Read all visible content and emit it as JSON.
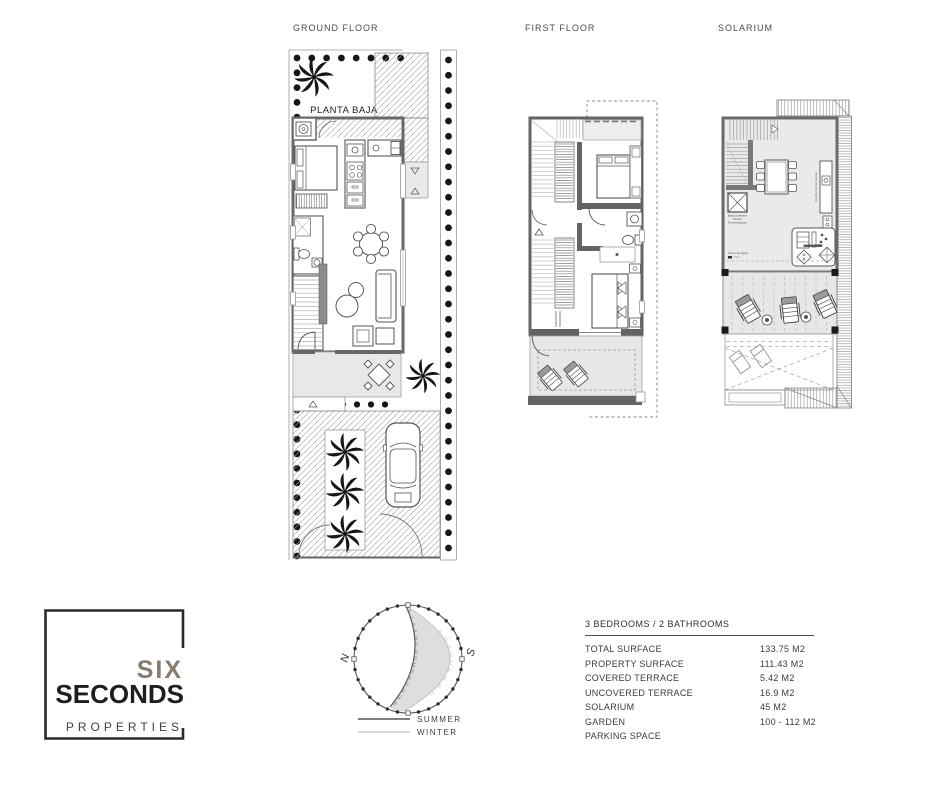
{
  "titles": {
    "ground": "GROUND FLOOR",
    "first": "FIRST FLOOR",
    "solarium": "SOLARIUM"
  },
  "ground_plan": {
    "room_label": "PLANTA BAJA"
  },
  "solarium_plan": {
    "annotations": {
      "skylight_1": "Base jardinera",
      "skylight_2": "Ducha",
      "skylight_3": "Preinstalación",
      "water_point": "Punto de Agua",
      "kitchen_vertical": "mueble cocina exterior",
      "bbq": "cocina exterior"
    }
  },
  "logo": {
    "line1": "SIX",
    "line2": "SECONDS",
    "line3": "PROPERTIES"
  },
  "sun": {
    "north": "N",
    "south": "S",
    "legend_summer": "SUMMER",
    "legend_winter": "WINTER",
    "summer_hours": [
      6,
      7,
      8,
      9,
      10,
      11,
      12,
      13,
      14,
      15,
      16,
      17,
      18,
      19,
      20
    ],
    "winter_hours": [
      9,
      10,
      11,
      12,
      13,
      14,
      15,
      16,
      17
    ]
  },
  "specs": {
    "header": "3 BEDROOMS / 2 BATHROOMS",
    "rows": [
      {
        "label": "TOTAL SURFACE",
        "value": "133.75 M2"
      },
      {
        "label": "PROPERTY SURFACE",
        "value": "111.43 M2"
      },
      {
        "label": "COVERED TERRACE",
        "value": "5.42 M2"
      },
      {
        "label": "UNCOVERED TERRACE",
        "value": "16.9 M2"
      },
      {
        "label": "SOLARIUM",
        "value": "45 M2"
      },
      {
        "label": "GARDEN",
        "value": "100 - 112 M2"
      },
      {
        "label": "PARKING SPACE",
        "value": ""
      }
    ]
  },
  "colors": {
    "wall": "#646464",
    "floor": "#e9eaea",
    "hatch": "#9b9b9b",
    "dots": "#161616",
    "logo_taupe": "#877c6d",
    "ink": "#201d1b"
  }
}
